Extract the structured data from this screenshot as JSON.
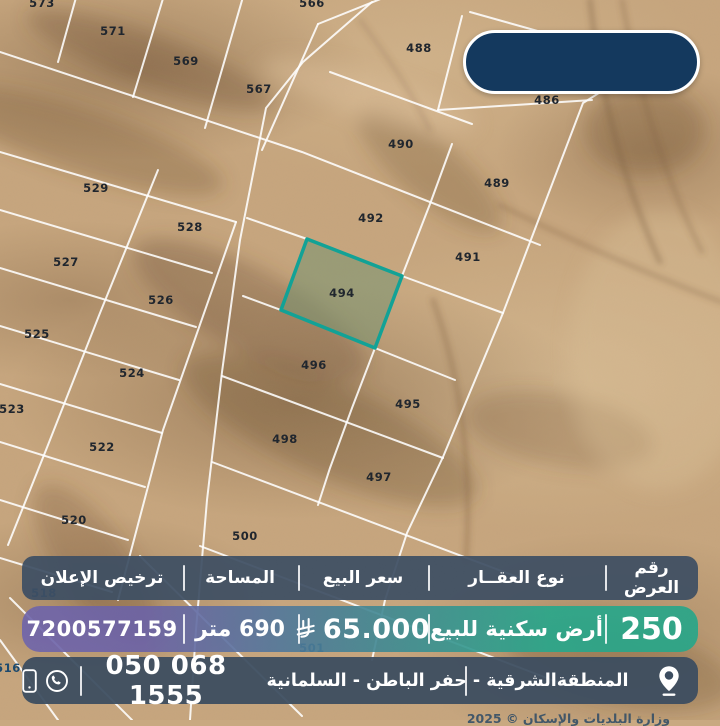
{
  "map": {
    "plots": [
      {
        "label": "573",
        "x": 42,
        "y": 7,
        "style": "dark"
      },
      {
        "label": "566",
        "x": 312,
        "y": 7,
        "style": "dark"
      },
      {
        "label": "571",
        "x": 113,
        "y": 35,
        "style": "dark"
      },
      {
        "label": "569",
        "x": 186,
        "y": 65,
        "style": "dark"
      },
      {
        "label": "567",
        "x": 259,
        "y": 93,
        "style": "dark"
      },
      {
        "label": "488",
        "x": 419,
        "y": 52,
        "style": "dark"
      },
      {
        "label": "486",
        "x": 547,
        "y": 104,
        "style": "dark"
      },
      {
        "label": "490",
        "x": 401,
        "y": 148,
        "style": "dark"
      },
      {
        "label": "489",
        "x": 497,
        "y": 187,
        "style": "dark"
      },
      {
        "label": "492",
        "x": 371,
        "y": 222,
        "style": "dark"
      },
      {
        "label": "491",
        "x": 468,
        "y": 261,
        "style": "dark"
      },
      {
        "label": "494",
        "x": 342,
        "y": 297,
        "style": "dark"
      },
      {
        "label": "496",
        "x": 314,
        "y": 369,
        "style": "dark"
      },
      {
        "label": "495",
        "x": 408,
        "y": 408,
        "style": "dark"
      },
      {
        "label": "498",
        "x": 285,
        "y": 443,
        "style": "dark"
      },
      {
        "label": "497",
        "x": 379,
        "y": 481,
        "style": "dark"
      },
      {
        "label": "500",
        "x": 245,
        "y": 540,
        "style": "dark"
      },
      {
        "label": "529",
        "x": 96,
        "y": 192,
        "style": "dark"
      },
      {
        "label": "528",
        "x": 190,
        "y": 231,
        "style": "dark"
      },
      {
        "label": "527",
        "x": 66,
        "y": 266,
        "style": "dark"
      },
      {
        "label": "526",
        "x": 161,
        "y": 304,
        "style": "dark"
      },
      {
        "label": "525",
        "x": 37,
        "y": 338,
        "style": "dark"
      },
      {
        "label": "524",
        "x": 132,
        "y": 377,
        "style": "dark"
      },
      {
        "label": "523",
        "x": 12,
        "y": 413,
        "style": "dark"
      },
      {
        "label": "522",
        "x": 102,
        "y": 451,
        "style": "dark"
      },
      {
        "label": "520",
        "x": 74,
        "y": 524,
        "style": "dark"
      },
      {
        "label": "518",
        "x": 44,
        "y": 597,
        "style": "navy"
      },
      {
        "label": "501",
        "x": 312,
        "y": 652,
        "style": "navy"
      },
      {
        "label": "516",
        "x": 8,
        "y": 672,
        "style": "navy"
      }
    ],
    "highlighted_plot": {
      "label": "494",
      "points": "307,239 402,276 375,348 281,310",
      "border_color": "#12a296",
      "fill_color": "rgba(122,148,114,0.58)"
    },
    "watermark": "وزارة البلديات والإسكان © 2025"
  },
  "table": {
    "header": {
      "offer_no": "رقم العرض",
      "property_type": "نوع العقــار",
      "price": "سعر البيع",
      "area": "المساحة",
      "license": "ترخيص الإعلان"
    },
    "values": {
      "offer_no": "250",
      "property_type": "أرض سكنية للبيع",
      "price": "65.000",
      "area": "690 متر",
      "license": "7200577159"
    },
    "contact": {
      "phone": "050 068 1555",
      "address": "المنطقةالشرقية - حفر الباطن - السلمانية"
    }
  },
  "icons": {
    "currency": "sar-riyal-symbol",
    "phone": "mobile-phone",
    "whatsapp": "whatsapp",
    "location": "map-pin"
  },
  "colors": {
    "header_navy": "#3d4f63",
    "contact_navy": "#3c4d60",
    "value_gradient_left": "#6e64ab",
    "value_gradient_mid": "#487e96",
    "value_gradient_right": "#28a689",
    "logo_pill": "#14395e",
    "highlight_teal": "#12a296"
  }
}
